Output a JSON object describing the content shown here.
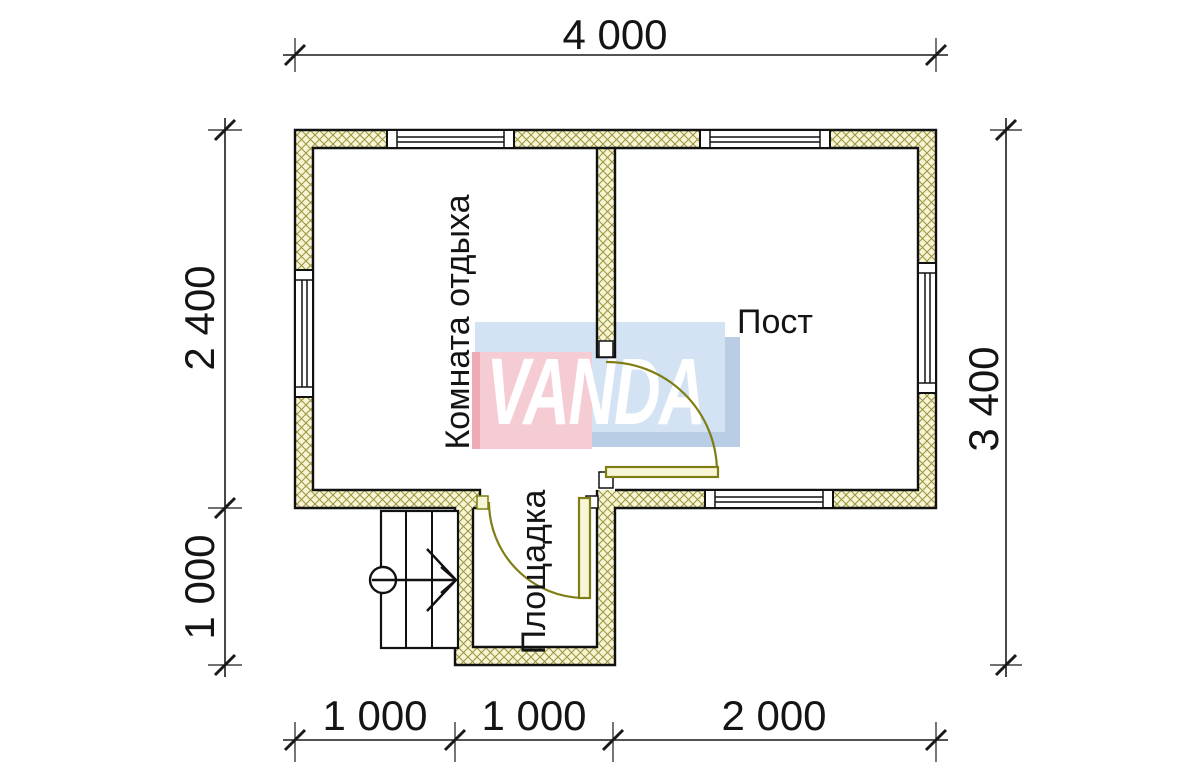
{
  "watermark": {
    "text": "VANDA",
    "pink_color": "#f5ccd3",
    "blue_color": "#d3e3f3",
    "shadow_color": "#b9cde5",
    "text_color": "#ffffff"
  },
  "rooms": {
    "rest_room": "Комната отдыха",
    "post": "Пост",
    "landing": "Площадка"
  },
  "dimensions": {
    "top": "4 000",
    "left_upper": "2 400",
    "left_lower": "1 000",
    "right": "3 400",
    "bottom_left": "1 000",
    "bottom_middle": "1 000",
    "bottom_right": "2 000"
  },
  "colors": {
    "wall_fill": "#f8f4d6",
    "wall_hatch": "#9b9840",
    "wall_outline": "#111111",
    "door_line": "#7e7e15",
    "dimension_line": "#1a1a1a"
  }
}
